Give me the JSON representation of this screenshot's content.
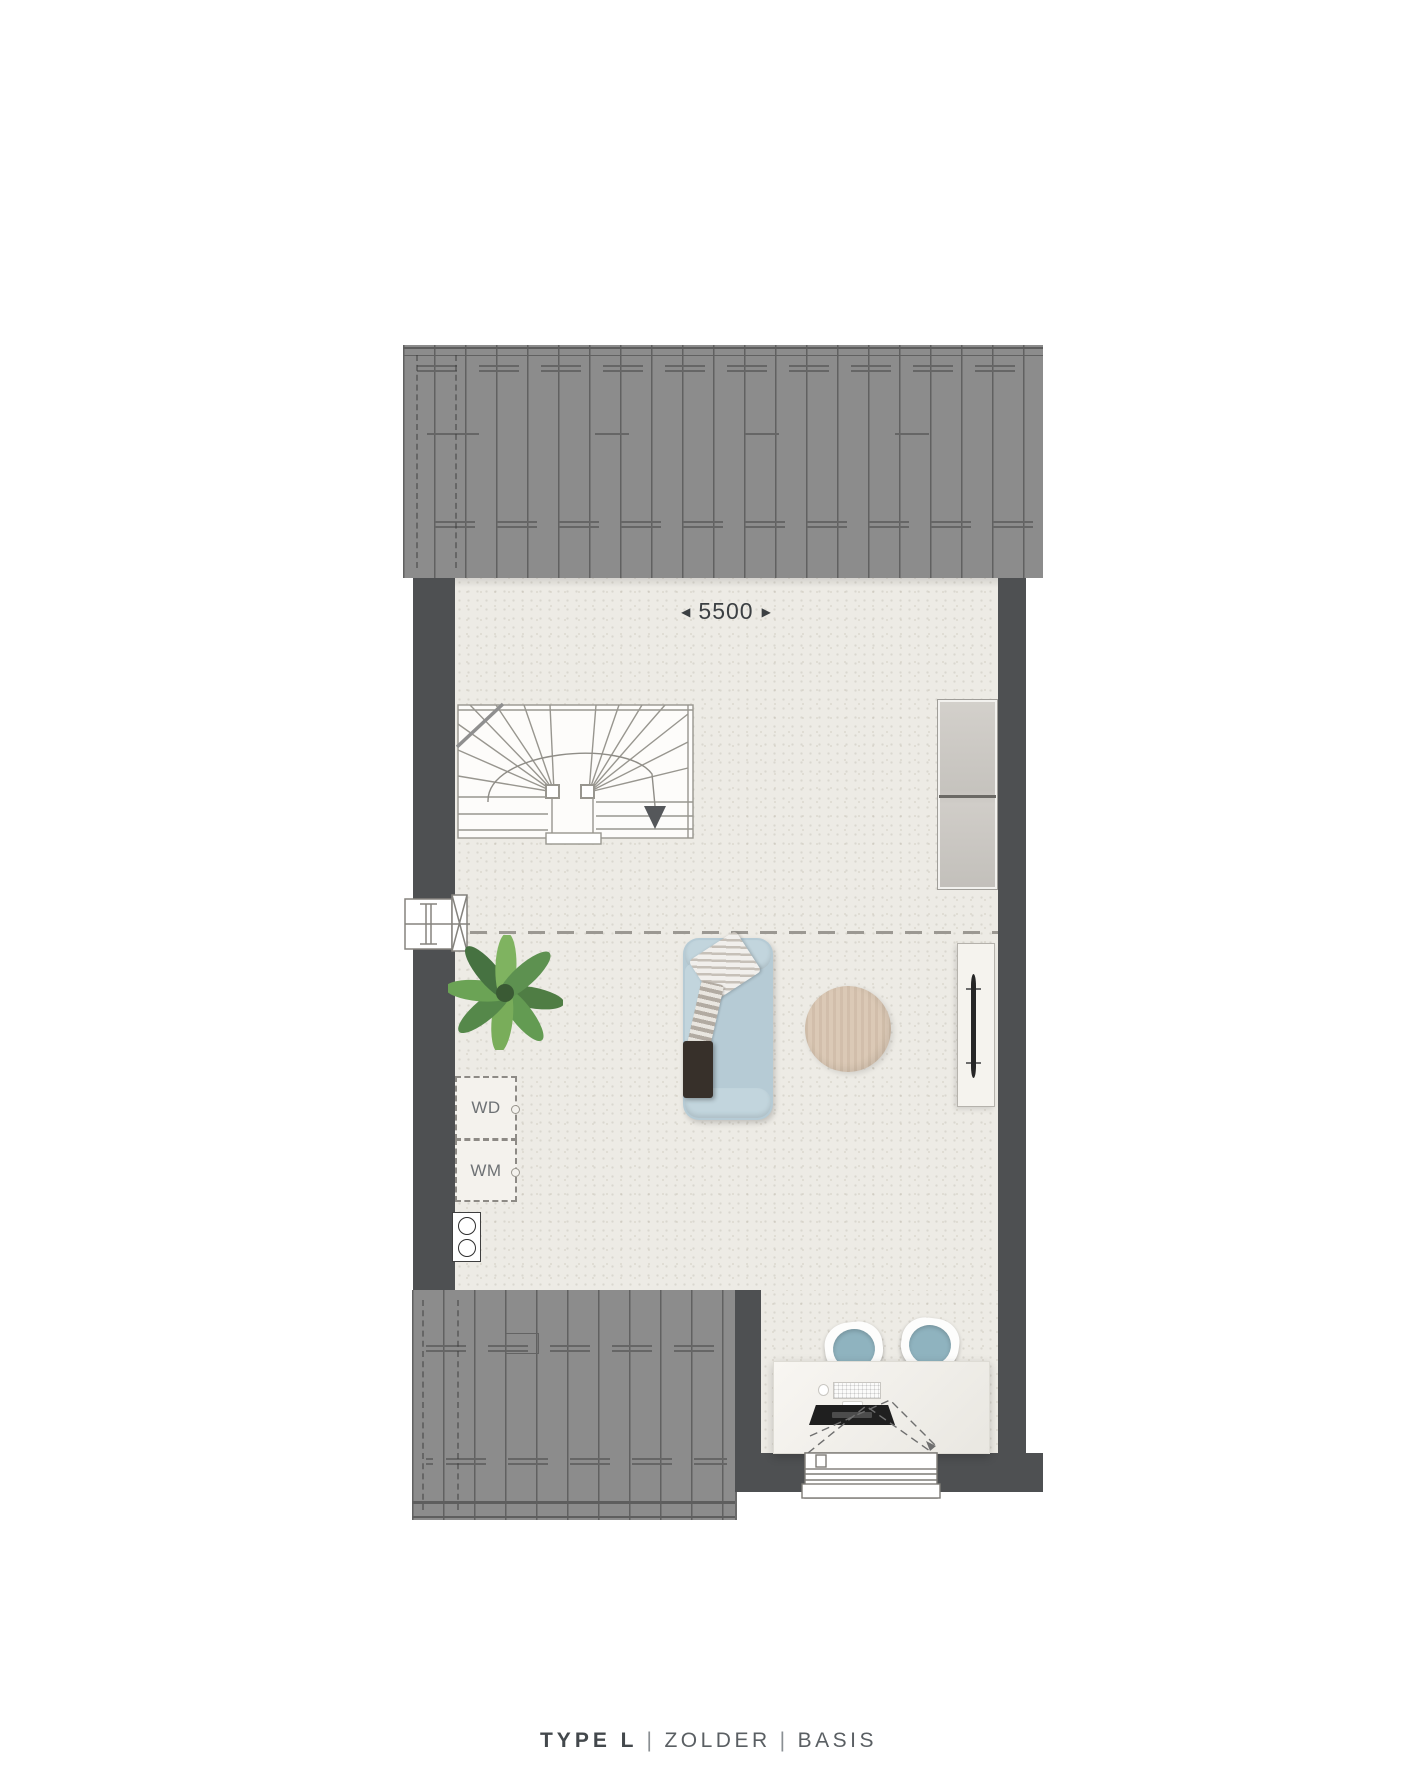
{
  "plan": {
    "dimension": {
      "left_arrow": "◀",
      "value": "5500",
      "right_arrow": "▶"
    },
    "appliances": {
      "dryer_label": "WD",
      "washer_label": "WM"
    }
  },
  "caption": {
    "type_label": "TYPE L",
    "separator": "|",
    "floor_label": "ZOLDER",
    "variant_label": "BASIS"
  },
  "colors": {
    "roof": "#8c8c8c",
    "wall": "#4e5052",
    "floor": "#edebe5",
    "sofa": "#b6cbd5",
    "table_wood": "#dbc9b6",
    "chair_seat": "#8fb3bf",
    "plant_green": "#5e8f50",
    "text_dark": "#3c4043",
    "text_muted": "#5a5f63"
  }
}
